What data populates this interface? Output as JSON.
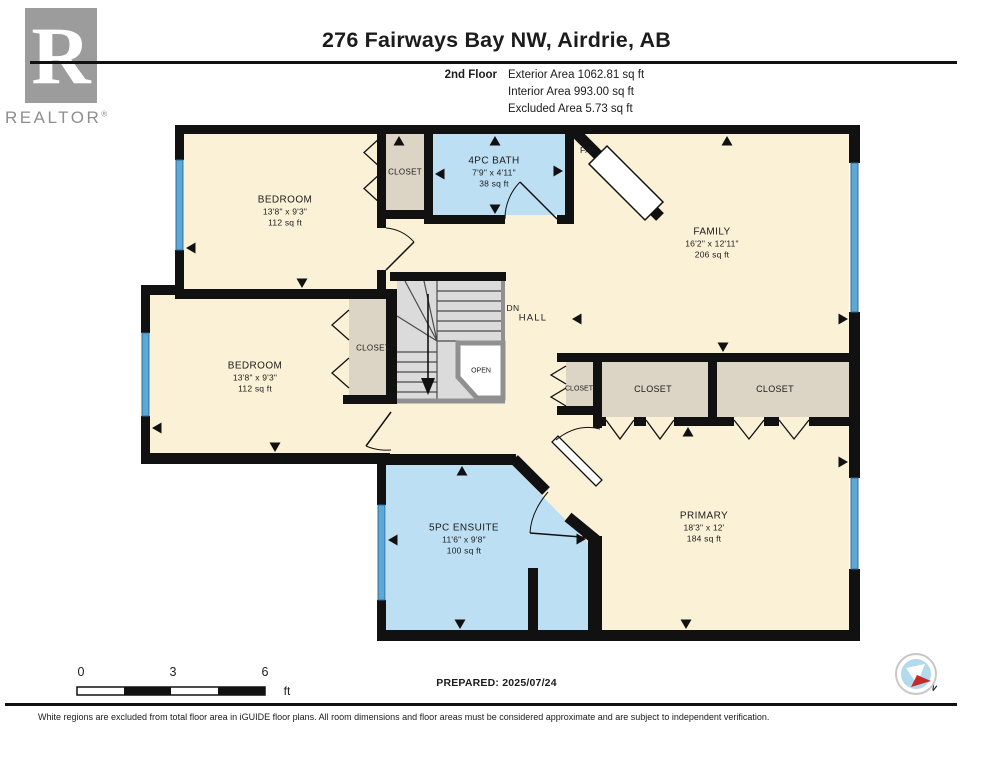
{
  "header": {
    "title": "276 Fairways Bay NW, Airdrie, AB",
    "floor_label": "2nd Floor",
    "areas": [
      "Exterior Area 1062.81 sq ft",
      "Interior Area 993.00 sq ft",
      "Excluded Area 5.73 sq ft"
    ]
  },
  "logo": {
    "letter": "R",
    "brand": "REALTOR",
    "registered": "®"
  },
  "rooms": [
    {
      "name": "BEDROOM",
      "dims": "13'8\" x 9'3\"",
      "area": "112 sq ft"
    },
    {
      "name": "4PC BATH",
      "dims": "7'9\" x 4'11\"",
      "area": "38 sq ft"
    },
    {
      "name": "FAMILY",
      "dims": "16'2\" x 12'11\"",
      "area": "206 sq ft"
    },
    {
      "name": "BEDROOM",
      "dims": "13'8\" x 9'3\"",
      "area": "112 sq ft"
    },
    {
      "name": "5PC ENSUITE",
      "dims": "11'6\" x 9'8\"",
      "area": "100 sq ft"
    },
    {
      "name": "PRIMARY",
      "dims": "18'3\" x 12'",
      "area": "184 sq ft"
    }
  ],
  "labels": {
    "closet": "CLOSET",
    "hall": "HALL",
    "dn": "DN",
    "open": "OPEN",
    "fp": "F/P",
    "north": "N"
  },
  "scale": {
    "ticks": [
      "0",
      "3",
      "6"
    ],
    "unit": "ft"
  },
  "footer": {
    "prepared": "PREPARED: 2025/07/24",
    "disclaimer": "White regions are excluded from total floor area in iGUIDE floor plans. All room dimensions and floor areas must be considered approximate and are subject to independent verification."
  },
  "colors": {
    "wall": "#111111",
    "room_beige": "#FAF1D6",
    "closet_tan": "#DCD4C5",
    "bath_blue": "#BCDFF3",
    "window_blue": "#5FA8D5",
    "stair_gray": "#DBDBDB",
    "stair_trim_gray": "#909090",
    "logo_gray": "#9C9C9C",
    "compass_red": "#C42B2B",
    "compass_blue": "#B3D9EC"
  }
}
